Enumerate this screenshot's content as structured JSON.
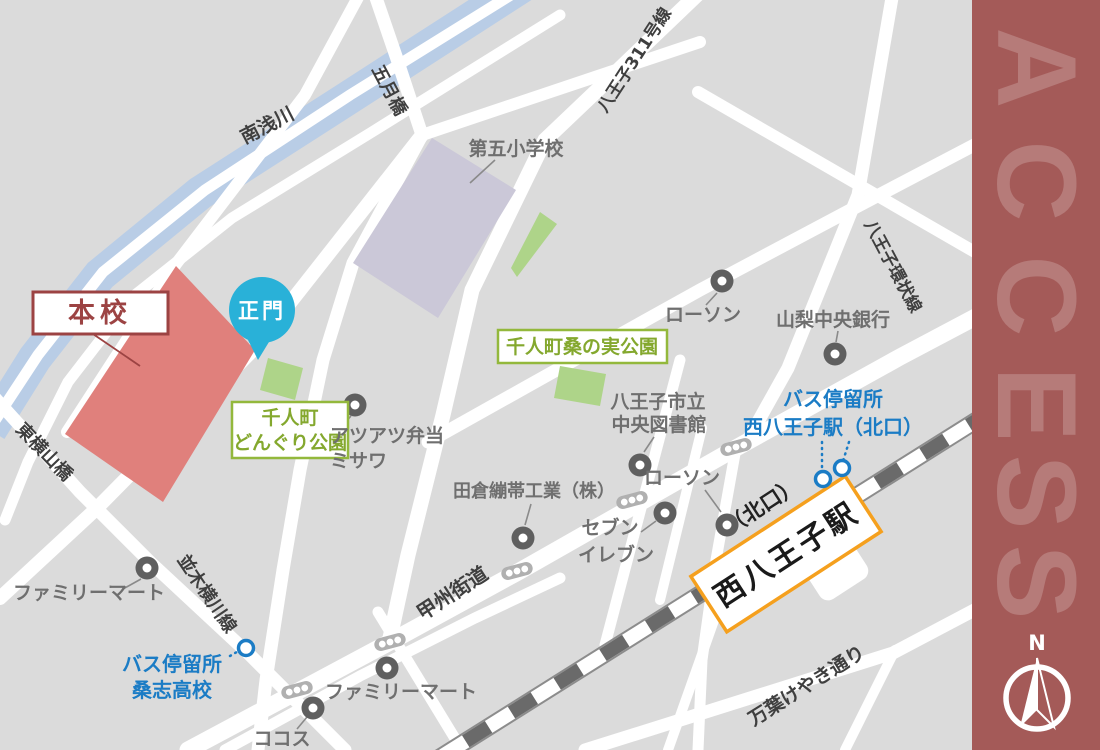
{
  "map": {
    "bg_color": "#dbdbdb",
    "road_color": "#ffffff",
    "river_color": "#b9cde6",
    "rail_color": "#6a6a6a",
    "roads": {
      "minamiasakawa": "南浅川",
      "satsukibashi": "五月橋",
      "hachioji311": "八王子311号線",
      "hachioji_kanjo": "八王子環状線",
      "koshu_kaido": "甲州街道",
      "namiki_yokokawa": "並木横川線",
      "higashi_yokoyamabashi": "東横山橋",
      "manyo_keyaki": "万葉けやき通り"
    },
    "school": {
      "honko": "本校",
      "seimon": "正門",
      "campus_color": "#e0807c",
      "box_color": "#9c4343",
      "balloon_color": "#29b1d8"
    },
    "station": {
      "name": "西八王子駅",
      "kitaguchi": "（北口）",
      "border_color": "#f5a01e"
    },
    "bus": {
      "color": "#1b7cc5",
      "stop_station_line1": "バス停留所",
      "stop_station_line2": "西八王子駅（北口）",
      "stop_soshi_line1": "バス停留所",
      "stop_soshi_line2": "桑志高校"
    },
    "parks": {
      "fill": "#aed489",
      "border_color": "#93b83c",
      "text_color": "#84a82e",
      "kuwanomi": "千人町桑の実公園",
      "donguri1": "千人町",
      "donguri2": "どんぐり公園"
    },
    "facilities": {
      "building_color": "#cbc8d8",
      "daigo_elementary": "第五小学校",
      "lawson_north": "ローソン",
      "yamanashi_bank": "山梨中央銀行",
      "atsuatsu1": "アツアツ弁当",
      "atsuatsu2": "ミサワ",
      "library1": "八王子市立",
      "library2": "中央図書館",
      "takura": "田倉繃帯工業（株）",
      "seven1": "セブン",
      "seven2": "イレブン",
      "lawson_station": "ローソン",
      "familymart_west": "ファミリーマート",
      "familymart_south": "ファミリーマート",
      "cocos": "ココス"
    }
  },
  "sidebar": {
    "bg": "#a45a58",
    "letters": [
      "A",
      "C",
      "C",
      "E",
      "S",
      "S"
    ],
    "compass_north": "N"
  }
}
